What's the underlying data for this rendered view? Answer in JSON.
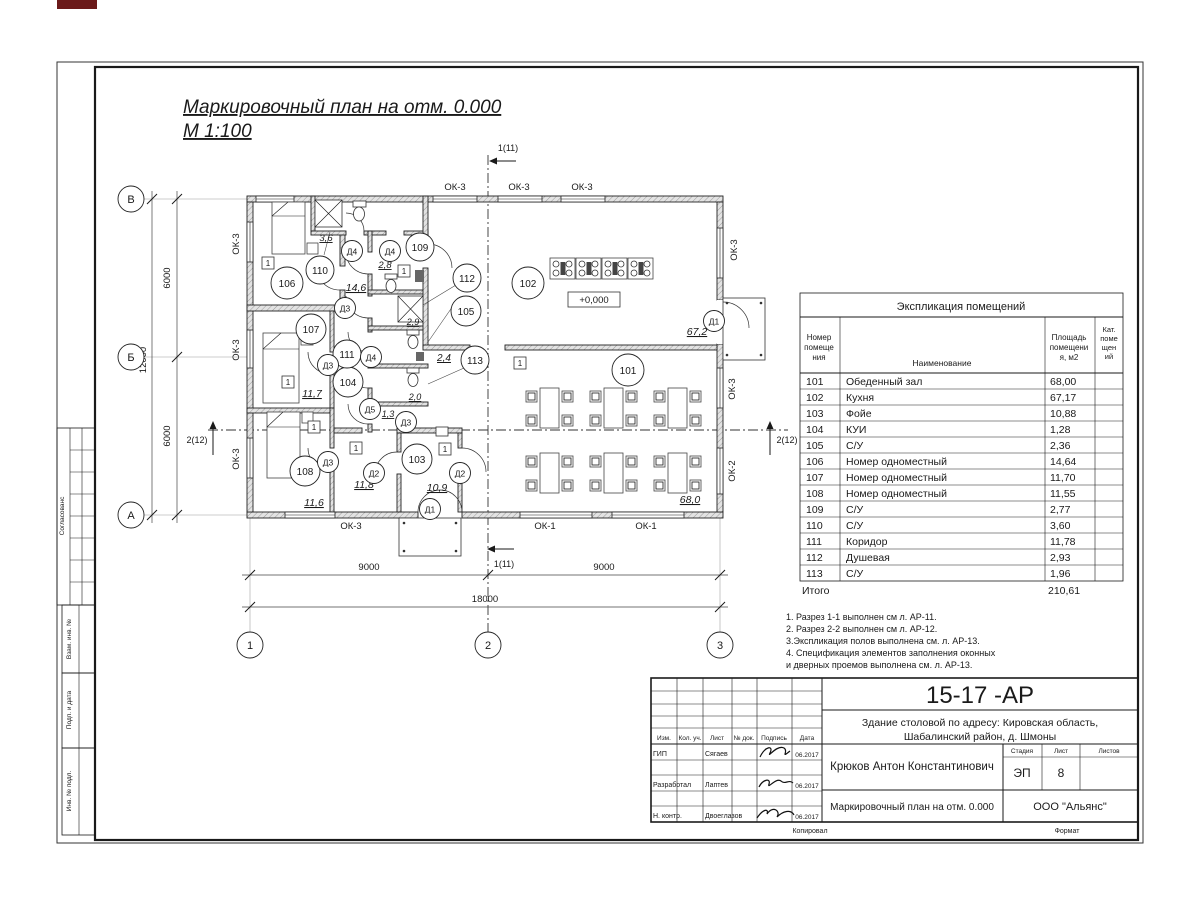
{
  "sheet_title": {
    "line1": "Маркировочный план  на отм. 0.000",
    "line2": "М 1:100"
  },
  "explication": {
    "title": "Экспликация помещений",
    "headers": {
      "num": [
        "Номер",
        "помеще",
        "ния"
      ],
      "name": "Наименование",
      "area": [
        "Площадь",
        "помещени",
        "я, м2"
      ],
      "cat": [
        "Кат.",
        "поме",
        "щен",
        "ий"
      ]
    },
    "rows": [
      {
        "num": "101",
        "name": "Обеденный зал",
        "area": "68,00"
      },
      {
        "num": "102",
        "name": "Кухня",
        "area": "67,17"
      },
      {
        "num": "103",
        "name": "Фойе",
        "area": "10,88"
      },
      {
        "num": "104",
        "name": "КУИ",
        "area": "1,28"
      },
      {
        "num": "105",
        "name": "С/У",
        "area": "2,36"
      },
      {
        "num": "106",
        "name": "Номер одноместный",
        "area": "14,64"
      },
      {
        "num": "107",
        "name": "Номер одноместный",
        "area": "11,70"
      },
      {
        "num": "108",
        "name": "Номер одноместный",
        "area": "11,55"
      },
      {
        "num": "109",
        "name": "С/У",
        "area": "2,77"
      },
      {
        "num": "110",
        "name": "С/У",
        "area": "3,60"
      },
      {
        "num": "111",
        "name": "Коридор",
        "area": "11,78"
      },
      {
        "num": "112",
        "name": "Душевая",
        "area": "2,93"
      },
      {
        "num": "113",
        "name": "С/У",
        "area": "1,96"
      }
    ],
    "total_label": "Итого",
    "total_value": "210,61"
  },
  "notes": {
    "lines": [
      "1. Разрез 1-1 выполнен см л. АР-11.",
      "2. Разрез 2-2 выполнен см л. АР-12.",
      "3.Экспликация полов выполнена  см. л. АР-13.",
      "4. Спецификация элементов заполнения оконных",
      " и дверных проемов выполнена  см. л. АР-13."
    ]
  },
  "plan": {
    "rooms": [
      {
        "number": "101",
        "area": "68,0"
      },
      {
        "number": "102",
        "area": "67,2"
      },
      {
        "number": "103",
        "area": "10,9"
      },
      {
        "number": "104",
        "area": "1,3"
      },
      {
        "number": "105",
        "area": "2,4"
      },
      {
        "number": "106",
        "area": "14,6"
      },
      {
        "number": "107",
        "area": "11,7"
      },
      {
        "number": "108",
        "area": "11,6"
      },
      {
        "number": "109",
        "area": "2,8"
      },
      {
        "number": "110",
        "area": "3,6"
      },
      {
        "number": "111",
        "area": "11,8"
      },
      {
        "number": "112",
        "area": "2,9"
      },
      {
        "number": "113",
        "area": "2,0"
      }
    ],
    "level_mark": "+0,000",
    "window_labels": {
      "ok1": "ОК-1",
      "ok2": "ОК-2",
      "ok3": "ОК-3"
    },
    "door_labels": {
      "d1": "Д1",
      "d2": "Д2",
      "d3": "Д3",
      "d4": "Д4",
      "d5": "Д5"
    },
    "axis": {
      "col1": "1",
      "col2": "2",
      "col3": "3",
      "rowA": "А",
      "rowB": "Б",
      "rowV": "В"
    },
    "dims": {
      "bottom_left": "9000",
      "bottom_right": "9000",
      "bottom_total": "18000",
      "left_top": "6000",
      "left_bottom": "6000",
      "left_total": "12000"
    },
    "sections": {
      "s1": "1(11)",
      "s2": "2(12)"
    },
    "floor_mark": "1"
  },
  "titleblock": {
    "doc_number": "15-17 -АР",
    "object_line1": "Здание столовой по адресу: Кировская область,",
    "object_line2": "Шабалинский район, д. Шмоны",
    "author": "Крюков Антон Константинович",
    "drawing_name": "Маркировочный план  на отм. 0.000",
    "company": "ООО \"Альянс\"",
    "stage_label": "Стадия",
    "stage": "ЭП",
    "sheet_label": "Лист",
    "sheet": "8",
    "sheets_label": "Листов",
    "cols": [
      "Изм.",
      "Кол. уч.",
      "Лист",
      "№ док.",
      "Подпись",
      "Дата"
    ],
    "rows": [
      {
        "role": "ГИП",
        "name": "Сягаев",
        "date": "06.2017"
      },
      {
        "role": "Разработал",
        "name": "Лаптев",
        "date": "06.2017"
      },
      {
        "role": "Н. контр.",
        "name": "Двоеглазов",
        "date": "06.2017"
      }
    ],
    "copied_label": "Копировал",
    "format_label": "Формат"
  },
  "margin_stamp": {
    "labels": [
      "Согласованс",
      "Взам. инв. №",
      "Подп. и дата",
      "Инв. № подл."
    ]
  }
}
